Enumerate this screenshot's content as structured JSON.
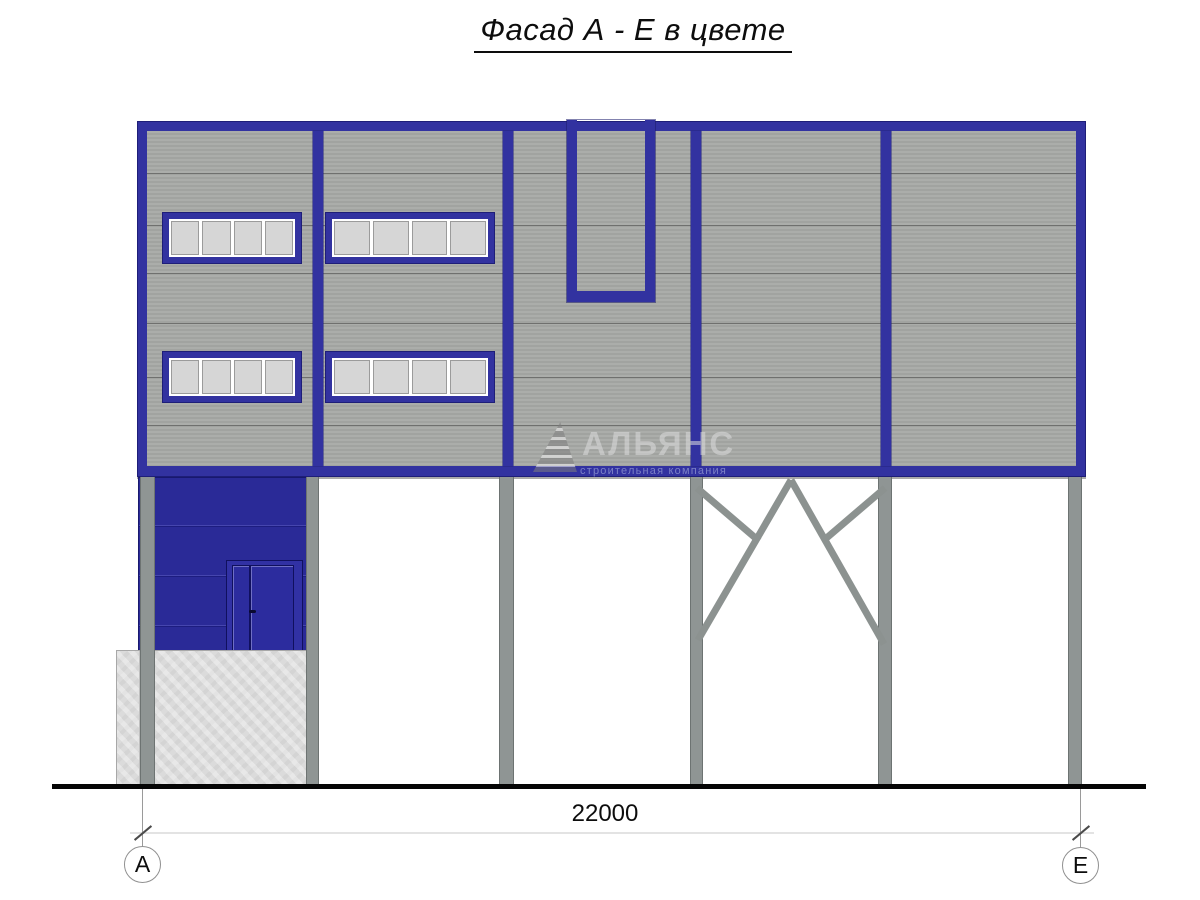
{
  "page": {
    "title": "Фасад А - Е в цвете"
  },
  "watermark": {
    "company": "АЛЬЯНС",
    "tagline": "строительная компания"
  },
  "dimension": {
    "total_width_mm": "22000"
  },
  "grid_bubbles": {
    "left": "А",
    "right": "Е"
  },
  "colors": {
    "frame_blue": "#3232a0",
    "entrance_wall_blue": "#2a2a97",
    "panel_gray": "#a6a8a5",
    "column_gray": "#8f9594",
    "concrete_gray": "#dbdbdb",
    "window_pane_gray": "#d6d6d6",
    "ground_black": "#050505"
  },
  "elements": {
    "window_rows": 2,
    "windows_per_row": 2,
    "panes_per_window": 4,
    "columns": 6
  }
}
